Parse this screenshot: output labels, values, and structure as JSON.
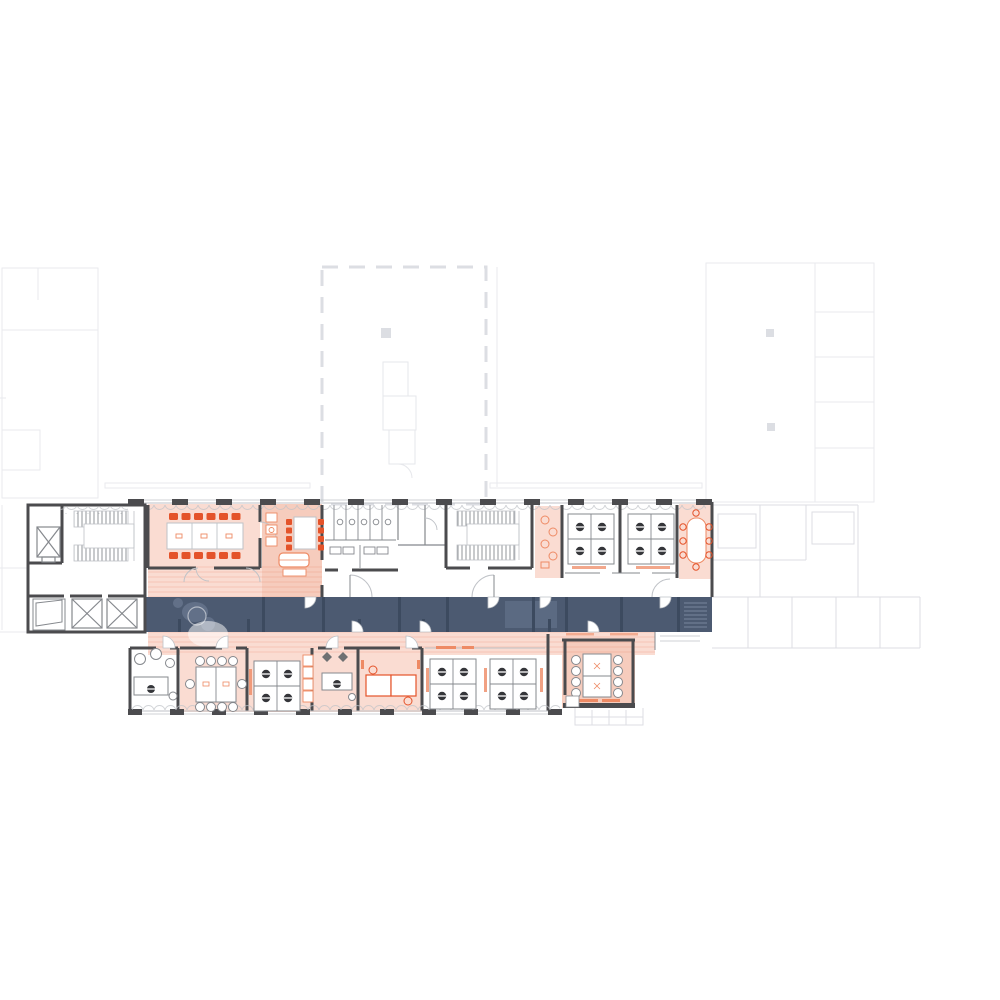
{
  "document": {
    "kind": "architectural-floor-plan",
    "visible_text": []
  },
  "colors": {
    "background": "#ffffff",
    "wall": "#4b4b4e",
    "wallLight": "#85888d",
    "lineLight": "#bfc2c7",
    "faint": "#e9eaee",
    "faint2": "#dcdee3",
    "innerFaint": "#e6e7eb",
    "salmonLight": "#fadcd2",
    "salmonMed": "#f6ccbd",
    "stripe": "rgba(226,90,56,0.13)",
    "orange": "#e4532a",
    "orangeSoft": "#ee8a64",
    "navy": "#4c5a71",
    "navyDark": "#3c4a5f",
    "navySoft": "#5b6a82",
    "ghost": "#74839c",
    "ghostLight": "#8593a9",
    "chairDark": "#35363a",
    "white": "#ffffff"
  },
  "icons": {
    "elevator-icon": "square with X diagonals",
    "stairs-icon": "hatched tread flights with landing",
    "toilet-icon": "small circle fixtures in stalls",
    "desk-pod-icon": "2x2 desk cluster with dark task chairs",
    "conference-table-icon": "long table with orange chairs",
    "dining-table-icon": "vertical table with orange chairs",
    "sofa-icon": "rounded lounge seat",
    "door-arc-icon": "quarter-circle swing",
    "window-icon": "scalloped curtain arcs along facade"
  },
  "zones": {
    "corridor": "dark navy circulation spine",
    "highlighted_rooms": "salmon tinted meeting / kitchen / office rooms",
    "context_wings": "very faint adjacent building wings (top-left, top-center, top-right, east)"
  }
}
